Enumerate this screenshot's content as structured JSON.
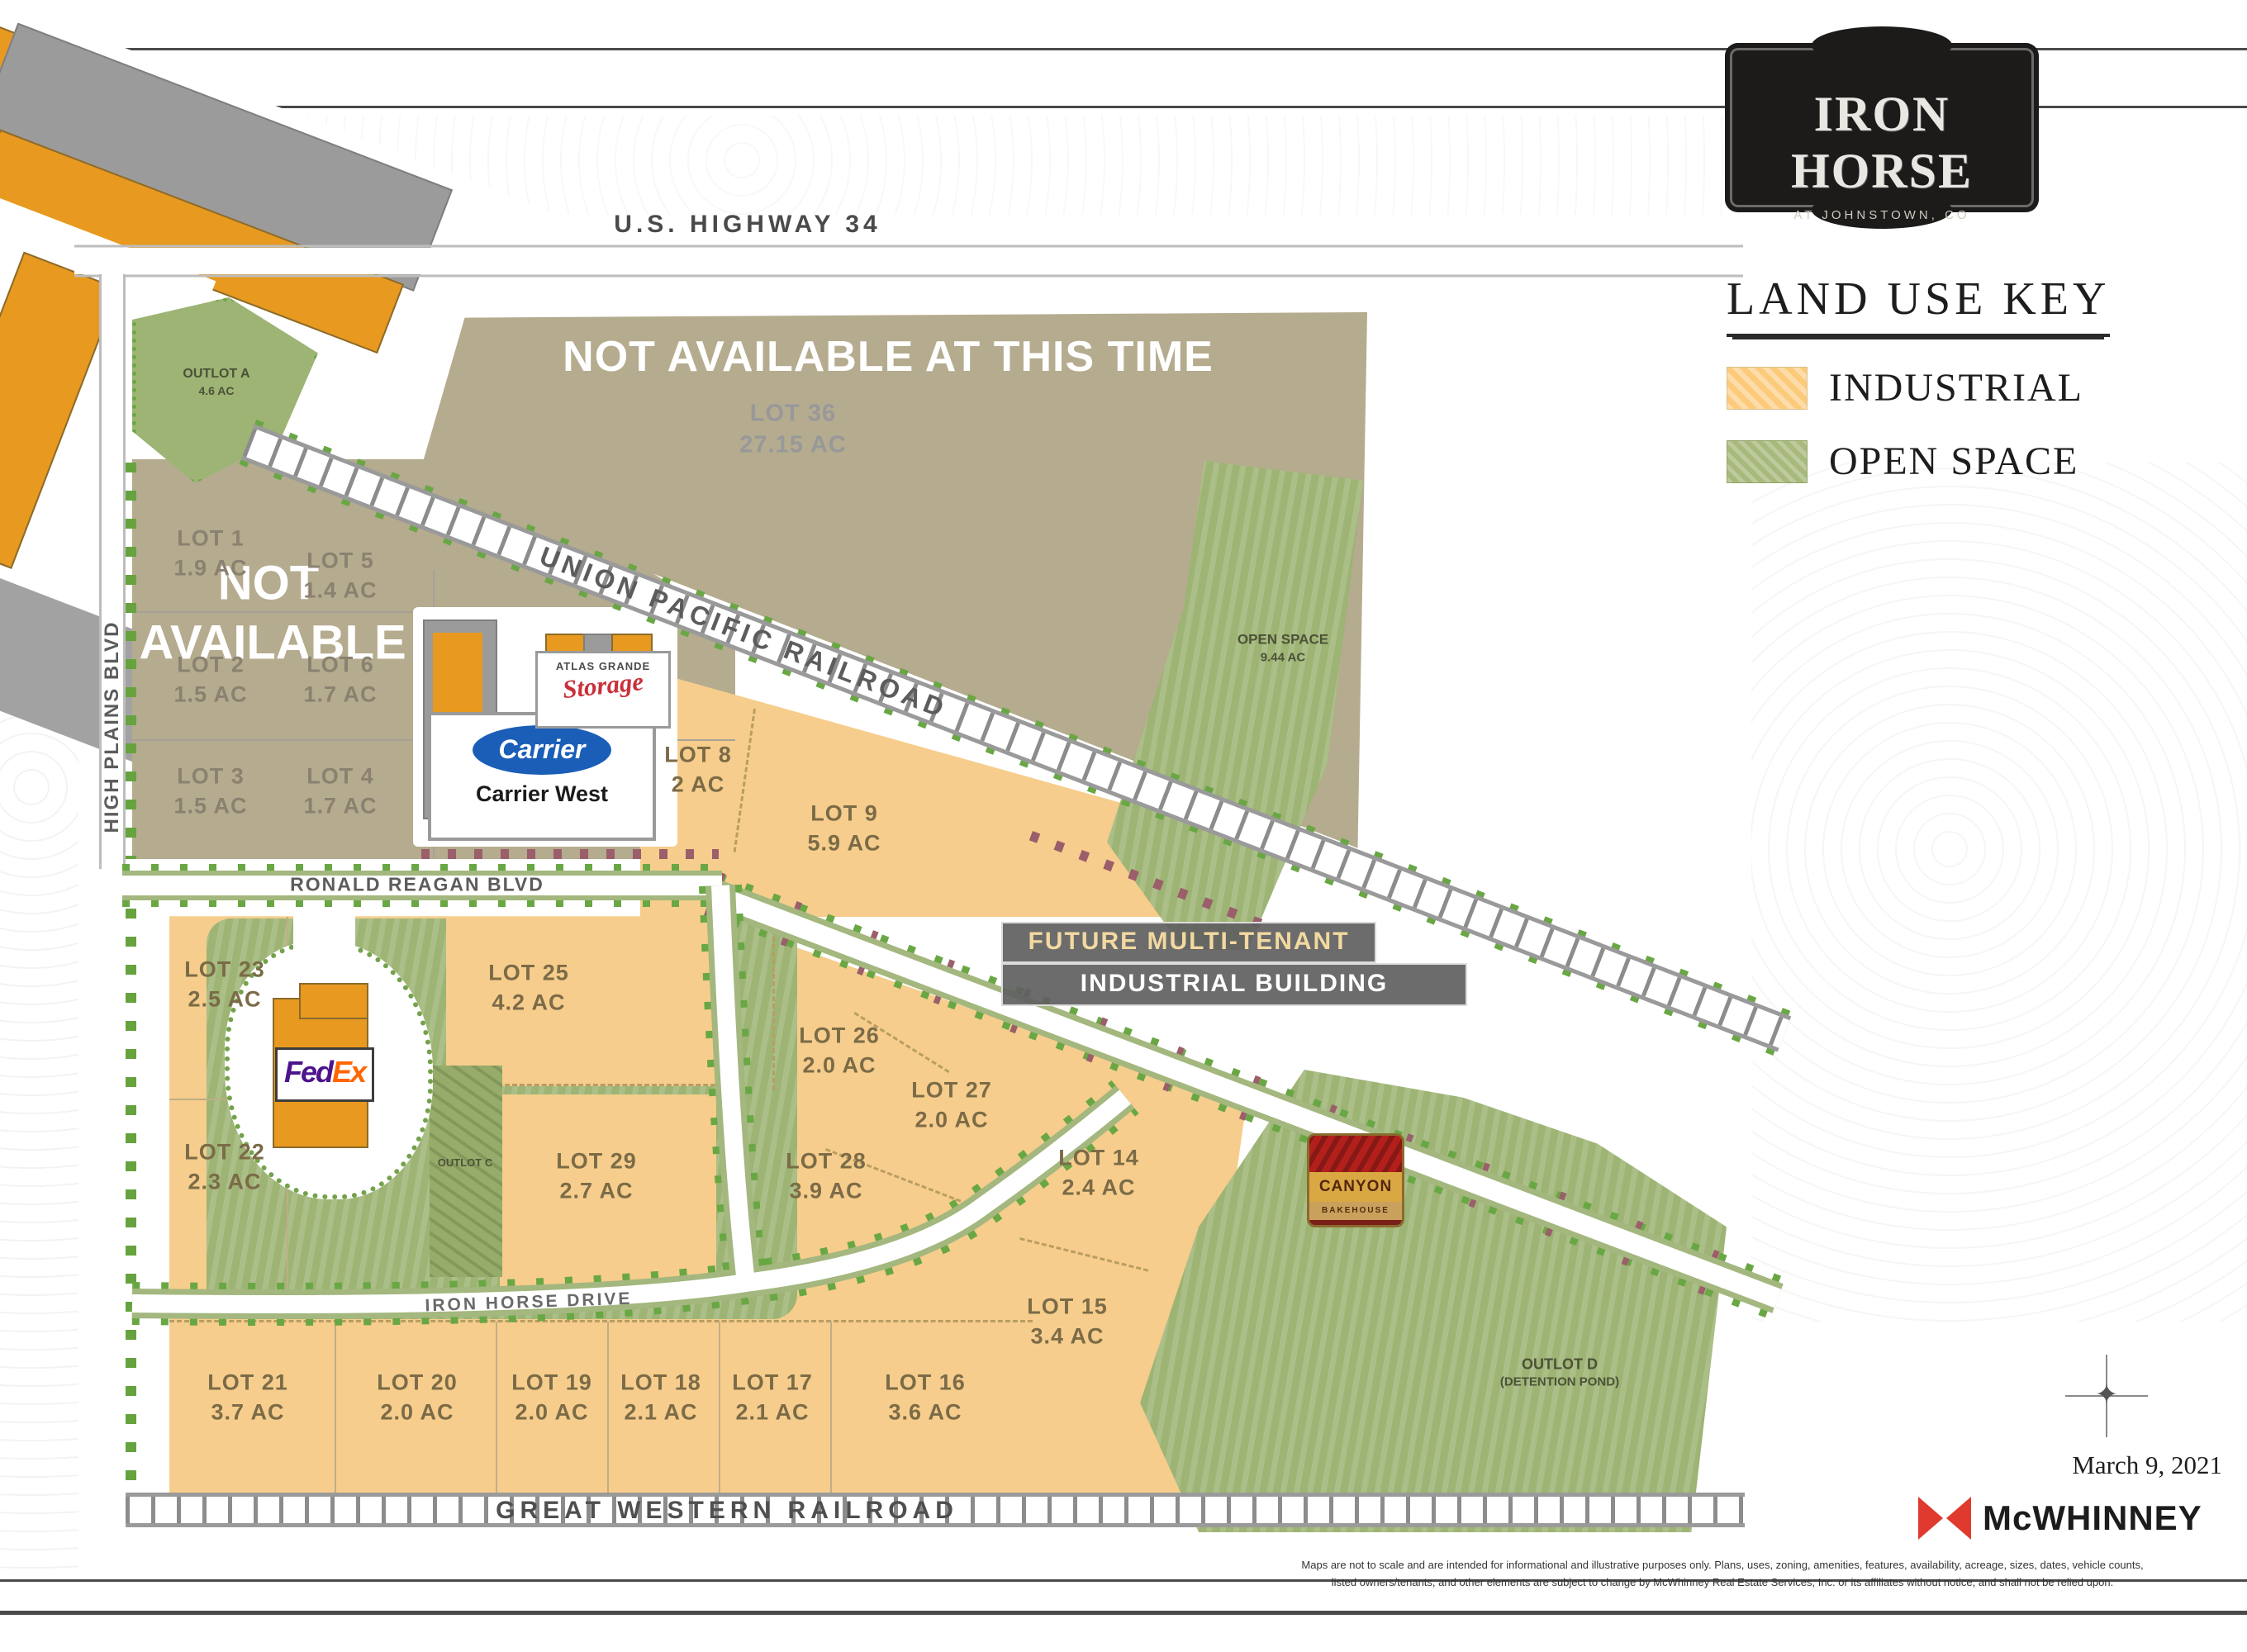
{
  "header": {
    "logo_title": "IRON HORSE",
    "logo_subtitle": "AT JOHNSTOWN, CO"
  },
  "legend": {
    "title": "LAND USE KEY",
    "items": [
      {
        "label": "INDUSTRIAL",
        "color": "#FBCB7B"
      },
      {
        "label": "OPEN SPACE",
        "color": "#A8B97C"
      }
    ]
  },
  "roads": {
    "us_highway": "U.S. HIGHWAY 34",
    "union_pacific": "UNION PACIFIC RAILROAD",
    "great_western": "GREAT WESTERN RAILROAD",
    "high_plains": "HIGH PLAINS BLVD",
    "ronald_reagan": "RONALD REAGAN BLVD",
    "iron_horse_drive": "IRON HORSE DRIVE"
  },
  "overlays": {
    "banner": "NOT AVAILABLE  AT THIS TIME",
    "block_line1": "NOT",
    "block_line2": "AVAILABLE"
  },
  "lots": [
    {
      "name": "LOT 1",
      "acreage": "1.9 AC"
    },
    {
      "name": "LOT 5",
      "acreage": "1.4 AC"
    },
    {
      "name": "LOT 2",
      "acreage": "1.5 AC"
    },
    {
      "name": "LOT 6",
      "acreage": "1.7 AC"
    },
    {
      "name": "LOT 3",
      "acreage": "1.5 AC"
    },
    {
      "name": "LOT 4",
      "acreage": "1.7 AC"
    },
    {
      "name": "LOT 36",
      "acreage": "27.15 AC"
    },
    {
      "name": "LOT 8",
      "acreage": "2 AC"
    },
    {
      "name": "LOT 9",
      "acreage": "5.9 AC"
    },
    {
      "name": "LOT 23",
      "acreage": "2.5 AC"
    },
    {
      "name": "LOT 25",
      "acreage": "4.2 AC"
    },
    {
      "name": "LOT 22",
      "acreage": "2.3 AC"
    },
    {
      "name": "LOT 26",
      "acreage": "2.0 AC"
    },
    {
      "name": "LOT 27",
      "acreage": "2.0 AC"
    },
    {
      "name": "LOT 29",
      "acreage": "2.7 AC"
    },
    {
      "name": "LOT 28",
      "acreage": "3.9 AC"
    },
    {
      "name": "LOT 14",
      "acreage": "2.4 AC"
    },
    {
      "name": "LOT 15",
      "acreage": "3.4 AC"
    },
    {
      "name": "LOT 21",
      "acreage": "3.7 AC"
    },
    {
      "name": "LOT 20",
      "acreage": "2.0 AC"
    },
    {
      "name": "LOT 19",
      "acreage": "2.0 AC"
    },
    {
      "name": "LOT 18",
      "acreage": "2.1 AC"
    },
    {
      "name": "LOT 17",
      "acreage": "2.1 AC"
    },
    {
      "name": "LOT 16",
      "acreage": "3.6 AC"
    }
  ],
  "outlots": {
    "a_name": "OUTLOT A",
    "a_acreage": "4.6 AC",
    "c_name": "OUTLOT C",
    "d_name": "OUTLOT D",
    "d_acreage": "(DETENTION POND)",
    "open_space_name": "OPEN SPACE",
    "open_space_acreage": "9.44 AC"
  },
  "buildings": {
    "future_line1": "FUTURE MULTI-TENANT",
    "future_line2": "INDUSTRIAL BUILDING"
  },
  "tenants": {
    "carrier_logo": "Carrier",
    "carrier_name": "Carrier West",
    "atlas_name": "ATLAS GRANDE",
    "atlas_script": "Storage",
    "fedex_fed": "Fed",
    "fedex_ex": "Ex",
    "canyon_name": "CANYON",
    "canyon_sub": "BAKEHOUSE"
  },
  "footer": {
    "date": "March 9, 2021",
    "brand": "McWHINNEY",
    "disclaimer_line1": "Maps are not to scale and are intended for informational and illustrative purposes only. Plans, uses, zoning, amenities, features, availability, acreage, sizes, dates, vehicle counts,",
    "disclaimer_line2": "listed owners/tenants, and other elements are subject to change by McWhinney Real Estate Services, Inc. or its affiliates without notice, and shall not be relied upon."
  },
  "colors": {
    "industrial": "#FBCB7B",
    "open_space": "#A8B97C",
    "not_available_tan": "#B5AB8E",
    "building_orange": "#E8991F",
    "building_gray": "#9B9B9B"
  }
}
